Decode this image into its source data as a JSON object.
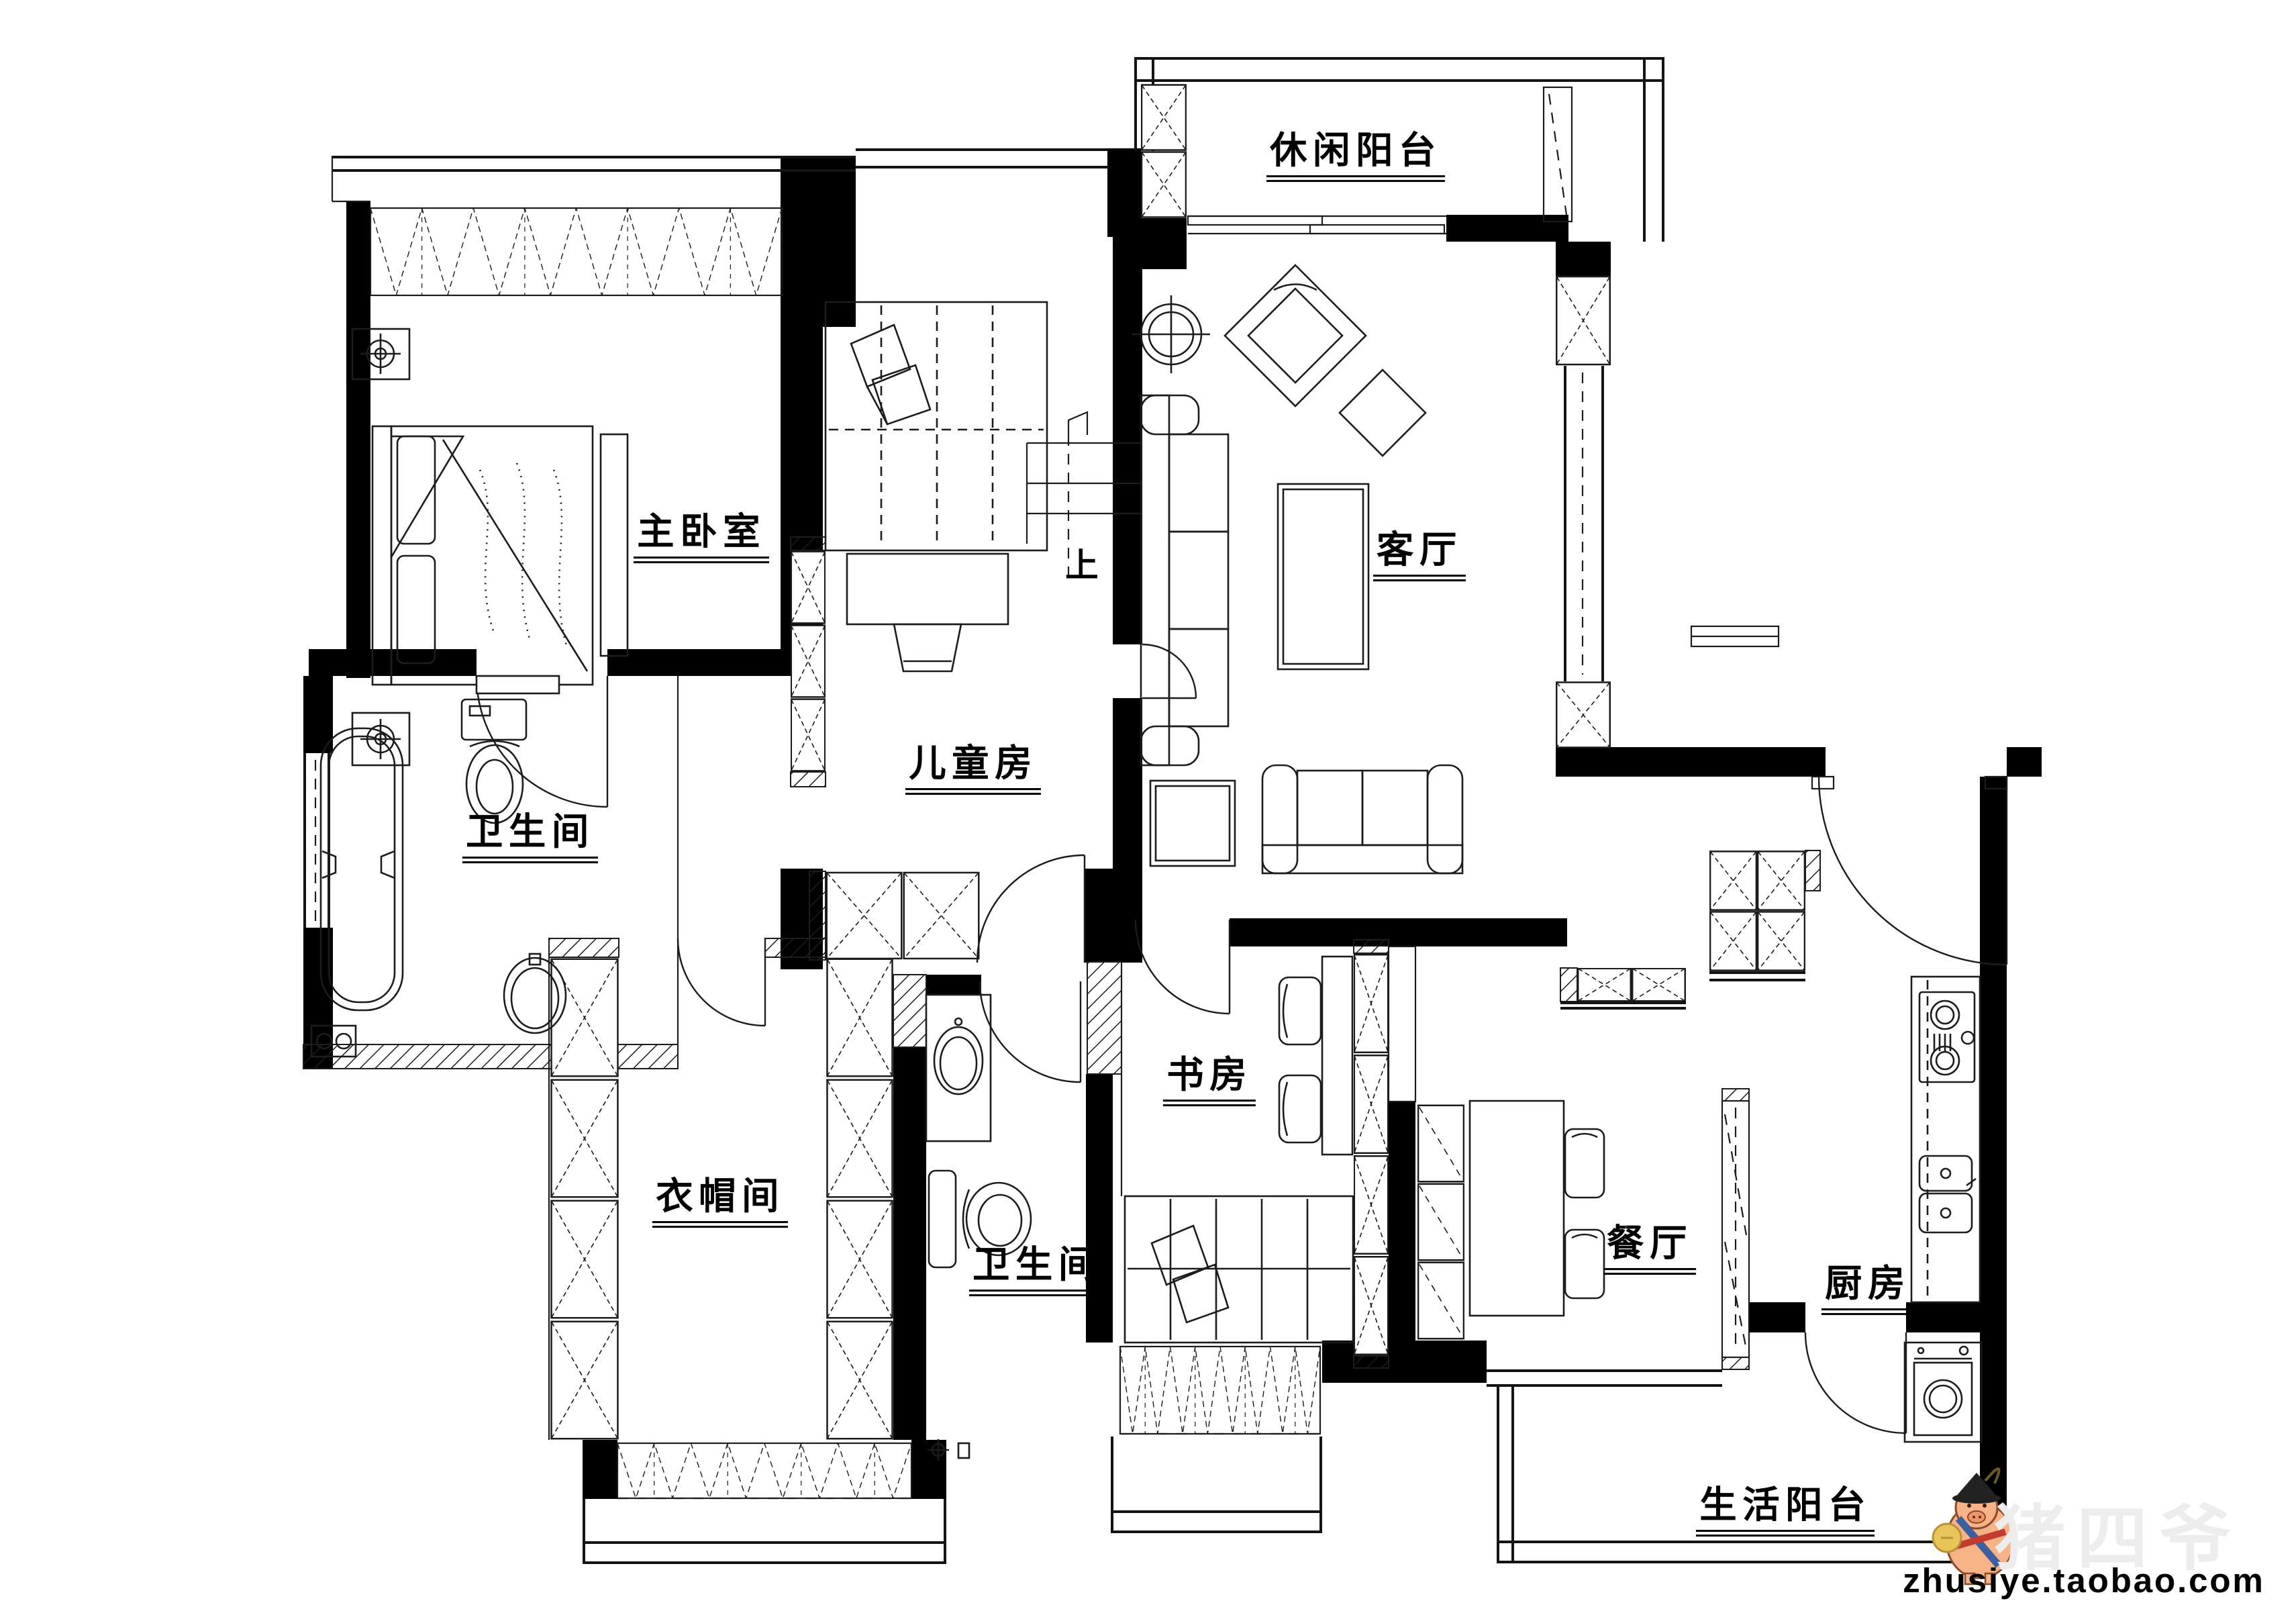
{
  "plan": {
    "rooms": [
      {
        "id": "leisure-balcony",
        "label": "休闲阳台"
      },
      {
        "id": "master-bedroom",
        "label": "主卧室"
      },
      {
        "id": "children-room",
        "label": "儿童房"
      },
      {
        "id": "living-room",
        "label": "客厅"
      },
      {
        "id": "master-bathroom",
        "label": "卫生间"
      },
      {
        "id": "cloakroom",
        "label": "衣帽间"
      },
      {
        "id": "second-bathroom",
        "label": "卫生间"
      },
      {
        "id": "study",
        "label": "书房"
      },
      {
        "id": "dining-room",
        "label": "餐厅"
      },
      {
        "id": "kitchen",
        "label": "厨房"
      },
      {
        "id": "utility-balcony",
        "label": "生活阳台"
      }
    ],
    "stairs": {
      "up_label": "上"
    }
  },
  "watermark": {
    "site_text": "zhusiye.taobao.com",
    "logo_text": "猪四爷"
  },
  "colors": {
    "background": "#ffffff",
    "walls": "#000000",
    "lines": "#1c1c1c",
    "watermark_text": "#000000",
    "logo_faint": "#ededed",
    "pig_body": "#f6b387",
    "pig_hat": "#222222",
    "pig_coin": "#e9c45a",
    "pig_sash_blue": "#3c5fa0",
    "pig_belt_red": "#c23b2e"
  }
}
